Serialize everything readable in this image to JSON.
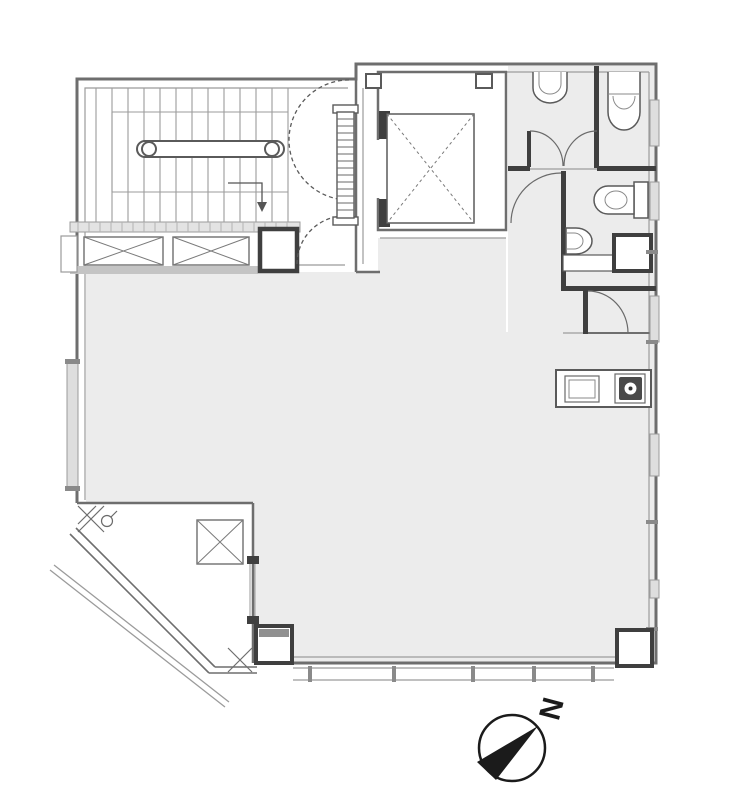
{
  "floorplan": {
    "kind": "architectural-floor-plan",
    "compass": {
      "label": "N",
      "rotation_deg": 105
    },
    "colors": {
      "background": "#ffffff",
      "room_fill": "#ececec",
      "wall_gray": "#6e6e6e",
      "dark_wall": "#3f3f3f",
      "line_light": "#9b9b9b",
      "fixture_stroke": "#5a5a5a",
      "window_fill": "#dedede",
      "sill_fill": "#e3e3e3",
      "band_bar_fill": "#c4c4c4",
      "black": "#1b1b1b"
    }
  }
}
